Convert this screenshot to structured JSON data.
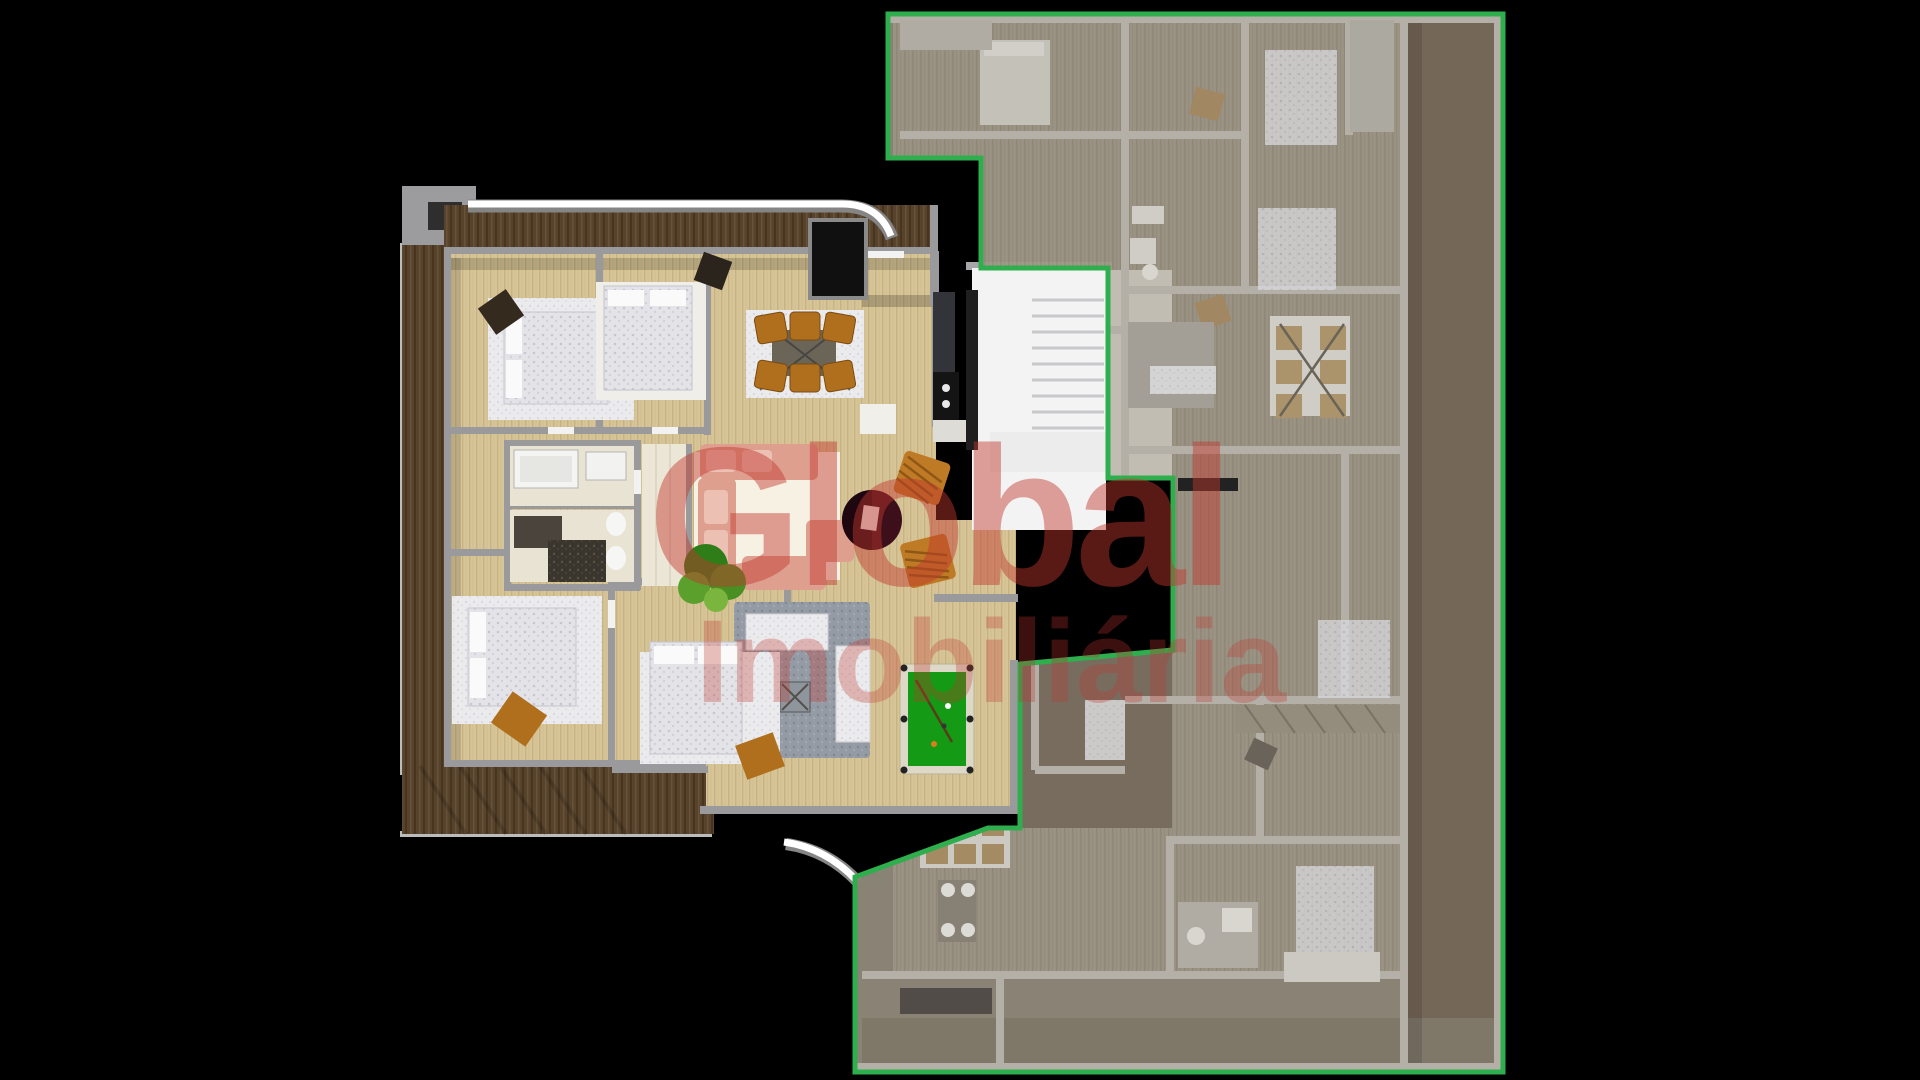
{
  "watermark": {
    "line1": "Global",
    "line2": "Imobiliária"
  },
  "colors": {
    "background": "#000000",
    "highlight_outline_green": "#2fae4e",
    "watermark_red": "#c2372e",
    "terrace_wood_dark": "#57432c",
    "interior_wood_light": "#d7c597",
    "faded_plan_floor": "#a19989",
    "faded_plan_side_strip": "#7a6c5c",
    "pool_table_green": "#149a14",
    "dining_chair_orange": "#b06f1d",
    "sofa_salmon": "#df9f8f",
    "walls_gray": "#9a9a9c",
    "stair_white": "#f3f3f3",
    "balcony_edge_white": "#ffffff"
  },
  "plan": {
    "view": "top-down 3d floorplan render",
    "left_unit": {
      "state": "full-color highlighted apartment",
      "rooms": [
        "bedroom-top-left",
        "bedroom-top-middle",
        "dining-area",
        "kitchen",
        "tv-nook",
        "bathroom-upper",
        "bathroom-lower",
        "hallway",
        "living-room",
        "bedroom-bottom-left",
        "bedroom-bottom-middle",
        "lounge",
        "games-room",
        "wrap-around-terrace"
      ],
      "furniture": [
        "double-bed",
        "double-bed",
        "dining-table-six-orange-chairs",
        "kitchen-counter-cooktop",
        "bathtub",
        "shower",
        "toilet",
        "bidet",
        "salmon-sofa-set",
        "dark-red-round-table",
        "wicker-armchairs",
        "plant",
        "gray-lounge-rug-with-sofas",
        "billiard-table"
      ]
    },
    "right_unit": {
      "state": "faded gray apartment outlined in green",
      "rooms": [
        "bedrooms",
        "bathrooms",
        "living-area",
        "dining-areas",
        "kitchen",
        "corridor",
        "balcony-strip"
      ],
      "furniture": [
        "beds",
        "dining-table-with-chairs",
        "sofas",
        "slatted-balcony"
      ]
    },
    "shared": {
      "stairwell": true
    }
  }
}
